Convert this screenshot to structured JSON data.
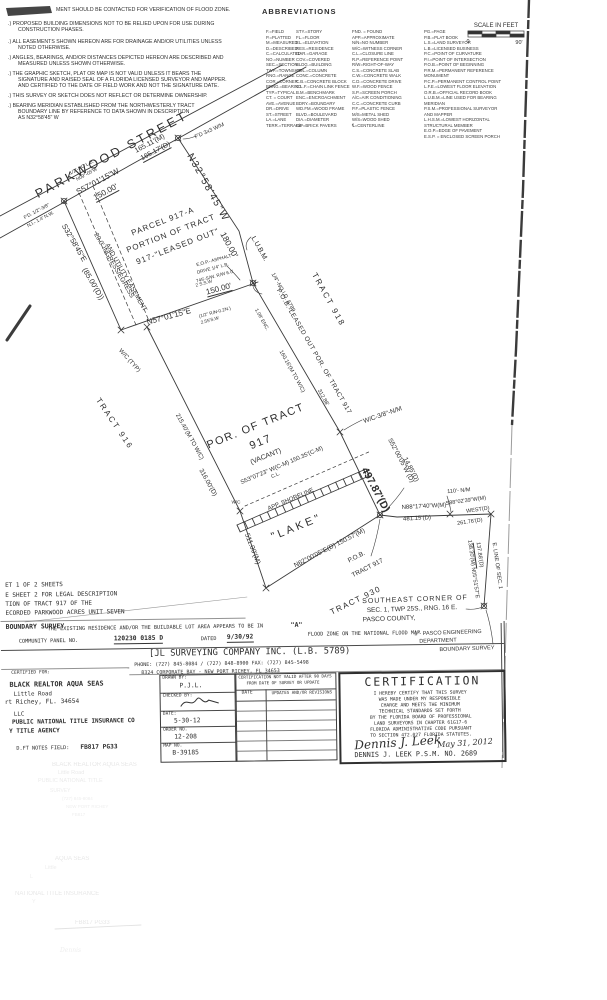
{
  "document": {
    "kind": "Boundary Survey plat (scanned)",
    "survey_title": "BOUNDARY SURVEY",
    "sheet_block": [
      "ET 1 OF 2 SHEETS",
      "E SHEET 2 FOR LEGAL DESCRIPTION",
      "TION OF TRACT 917 OF THE",
      "ECORDED PARKWOOD ACRES UNIT SEVEN"
    ]
  },
  "scale_bar": {
    "label": "SCALE IN FEET",
    "left_tick": "0",
    "right_tick": "90'"
  },
  "abbr": {
    "title": "ABBREVIATIONS",
    "col_x": [
      266,
      296,
      352,
      424
    ],
    "col_w": [
      30,
      55,
      70,
      80
    ],
    "top_y": 29,
    "cols": [
      [
        "F.=FIELD",
        "P.=PLATTED",
        "M.=MEASURED",
        "D.=DESCRIBED",
        "C.=CALCULATED",
        "NO.=NUMBER",
        "SEC.=SECTION",
        "TWP.=TOWNSHIP",
        "RNG.=RANGE",
        "COR.=CORNER",
        "BRNG.=BEARING",
        "TYP.=TYPICAL",
        "CT. = COURT",
        "AVE.=AVENUE",
        "DR.=DRIVE",
        "ST.=STREET",
        "LA.=LANE",
        "TERR.=TERRACE"
      ],
      [
        "STY.=STORY",
        "FL.=FLOOR",
        "EL.=ELEVATION",
        "RES.=RESIDENCE",
        "GAR.=GARAGE",
        "COV.=COVERED",
        "BLDG.=BUILDING",
        "COL.=COLUMN",
        "CONC.=CONCRETE",
        "C.B.=CONCRETE BLOCK",
        "C.L.F.=CHAIN LINK FENCE",
        "B.M.=BENCHMARK",
        "ENC.=ENCROACHMENT",
        "BDRY.=BOUNDARY",
        "WD.FM.=WOOD FRAME",
        "BLVD.=BOULEVARD",
        "DIA.=DIAMETER",
        "B/P=BRICK PAVERS"
      ],
      [
        "FND. = FOUND",
        "APP.=APPROXIMATE",
        "N/N=NO NUMBER",
        "W/C=WITNESS CORNER",
        "C.L.=CLOSURE LINE",
        "R.P.=REFERENCE POINT",
        "R/W=RIGHT-OF-WAY",
        "C.S.=CONCRETE SLAB",
        "C.W.=CONCRETE WALK",
        "C.D.=CONCRETE DRIVE",
        "W.F.=WOOD FENCE",
        "S.P.=SCREEN PORCH",
        "A/C=AIR CONDITIONING",
        "C.C.=CONCRETE CURB",
        "P.F.=PLASTIC FENCE",
        "M/S=METAL SHED",
        "W/S=WOOD SHED",
        "℄=CENTERLINE"
      ],
      [
        "PG.=PAGE",
        "P.B.=PLAT BOOK",
        "L.S.=LAND SURVEYOR",
        "L.B.=LICENSED BUSINESS",
        "P.C.=POINT OF CURVATURE",
        "P.I.=POINT OF INTERSECTION",
        "P.O.B.=POINT OF BEGINNING",
        "P.R.M.=PERMANENT REFERENCE MONUMENT",
        "P.C.P.=PERMANENT CONTROL POINT",
        "L.F.E.=LOWEST FLOOR ELEVATION",
        "O.R.B.=OFFICIAL RECORD BOOK",
        "L.U.B.M.=LINE USED FOR BEARING MERIDIAN",
        "P.S.M.=PROFESSIONAL SURVEYOR AND MAPPER",
        "L.H.S.M.=LOWEST HORIZONTAL STRUCTURAL MEMBER",
        "E.O.P.=EDGE OF PAVEMENT",
        "E.S.P. = ENCLOSED SCREEN PORCH"
      ]
    ]
  },
  "notes": [
    {
      "t": "MENT SHOULD BE CONTACTED FOR VERIFICATION OF FLOOD ZONE.",
      "x": 56,
      "y": 8
    },
    {
      "t": ".) PROPOSED BUILDING DIMENSIONS NOT TO BE RELIED UPON FOR USE DURING",
      "x": 8,
      "y": 22
    },
    {
      "t": "CONSTRUCTION PHASES.",
      "x": 18,
      "y": 28
    },
    {
      "t": ".) ALL EASEMENTS SHOWN HEREON ARE FOR DRAINAGE AND/OR UTILITIES UNLESS",
      "x": 8,
      "y": 40
    },
    {
      "t": "NOTED OTHERWISE.",
      "x": 18,
      "y": 46
    },
    {
      "t": ".) ANGLES, BEARINGS, AND/OR DISTANCES DEPICTED HEREON ARE DESCRIBED AND",
      "x": 8,
      "y": 56
    },
    {
      "t": "MEASURED UNLESS SHOWN OTHERWISE.",
      "x": 18,
      "y": 62
    },
    {
      "t": ".) THE GRAPHIC SKETCH, PLAT OR MAP IS NOT VALID UNLESS IT BEARS THE",
      "x": 8,
      "y": 72
    },
    {
      "t": "SIGNATURE AND RAISED SEAL OF A FLORIDA LICENSED SURVEYOR AND MAPPER.",
      "x": 18,
      "y": 78
    },
    {
      "t": "AND CERTIFIED TO THE DATE OF FIELD WORK AND NOT THE SIGNATURE DATE.",
      "x": 18,
      "y": 84
    },
    {
      "t": ".) THIS SURVEY OR SKETCH DOES NOT REFLECT OR DETERMINE OWNERSHIP.",
      "x": 8,
      "y": 94
    },
    {
      "t": ".) BEARING MERIDIAN ESTABLISHED FROM THE NORTHWESTERLY TRACT",
      "x": 8,
      "y": 104
    },
    {
      "t": "BOUNDARY LINE BY REFERENCE TO DATA SHOWN IN DESCRIPTION",
      "x": 18,
      "y": 110
    },
    {
      "t": "AS N32°58'45\" W",
      "x": 18,
      "y": 116
    }
  ],
  "plat_labels": [
    {
      "t": "SCALE IN FEET",
      "x": 496,
      "y": 26,
      "s": 6,
      "n": "scale-bar-label"
    },
    {
      "t": "0",
      "x": 468,
      "y": 43,
      "s": 5.5,
      "n": "scale-zero"
    },
    {
      "t": "90'",
      "x": 519,
      "y": 44,
      "s": 5.5,
      "n": "scale-ninety"
    },
    {
      "t": "PARKWOOD  STREET",
      "x": 112,
      "y": 155,
      "r": -28,
      "s": 12.5,
      "ls": 3,
      "n": "parkwood-street-label"
    },
    {
      "t": "165.11'(M)",
      "x": 150,
      "y": 144,
      "r": -28,
      "s": 7
    },
    {
      "t": "165.17'(D)",
      "x": 156,
      "y": 152,
      "r": -28,
      "s": 7,
      "u": 1
    },
    {
      "t": "S57°01'15\"W",
      "x": 98,
      "y": 182,
      "r": -28,
      "s": 8
    },
    {
      "t": "150.00'",
      "x": 106,
      "y": 193,
      "r": -28,
      "s": 8,
      "u": 1
    },
    {
      "t": "F'D 3x3 W/M",
      "x": 210,
      "y": 132,
      "r": -24,
      "s": 5.5
    },
    {
      "t": "1/2\"-NO L.B.",
      "x": 82,
      "y": 168,
      "r": -28,
      "s": 4.8
    },
    {
      "t": "N09°-05'W",
      "x": 87,
      "y": 175,
      "r": -28,
      "s": 4.8
    },
    {
      "t": "F'D. 1/2\"-3/8\"",
      "x": 37,
      "y": 212,
      "r": -28,
      "s": 4.8
    },
    {
      "t": "N.I.- 1.4' N.W.",
      "x": 41,
      "y": 220,
      "r": -28,
      "s": 4.8
    },
    {
      "t": "N32°58'45\"W",
      "x": 207,
      "y": 188,
      "r": 61,
      "s": 10,
      "ls": 1.5
    },
    {
      "t": "180.00'",
      "x": 229,
      "y": 245,
      "r": 61,
      "s": 8.5
    },
    {
      "t": "L.U.B.M.",
      "x": 259,
      "y": 249,
      "r": 61,
      "s": 7
    },
    {
      "t": "1/4\"-NO I.D. 5789",
      "x": 282,
      "y": 293,
      "r": 61,
      "s": 5.5
    },
    {
      "t": "P.O.B.-LEASED OUT POR. OF TRACT 917",
      "x": 313,
      "y": 352,
      "r": 60,
      "s": 6.5,
      "ls": 0.5
    },
    {
      "t": "TRACT 918",
      "x": 328,
      "y": 300,
      "r": 61,
      "s": 8,
      "ls": 2,
      "n": "tract-918-label"
    },
    {
      "t": "1.08' ENC.",
      "x": 261,
      "y": 320,
      "r": 61,
      "s": 5
    },
    {
      "t": "160.16'(M TO W/C)",
      "x": 291,
      "y": 372,
      "r": 61,
      "s": 5.5
    },
    {
      "t": "312.88'",
      "x": 322,
      "y": 398,
      "r": 61,
      "s": 5.5
    },
    {
      "t": "W/C-3/8\"-N/M",
      "x": 383,
      "y": 416,
      "r": -19,
      "s": 6.5
    },
    {
      "t": "497.87'(D)",
      "x": 375,
      "y": 490,
      "r": 62,
      "s": 10.5,
      "w": 700
    },
    {
      "t": "S52°00'05\"W (D)",
      "x": 400,
      "y": 461,
      "r": 62,
      "s": 6.5
    },
    {
      "t": "14.85'(D)",
      "x": 410,
      "y": 470,
      "r": 62,
      "s": 6.5
    },
    {
      "t": "S32°58'45\"E",
      "x": 74,
      "y": 243,
      "r": 60,
      "s": 7.5
    },
    {
      "t": "(85.00'(D))",
      "x": 93,
      "y": 284,
      "r": 60,
      "s": 7.5
    },
    {
      "t": "20.0' INGRESS/EGRESS",
      "x": 113,
      "y": 266,
      "r": 60,
      "s": 6.5
    },
    {
      "t": "AND UTILITY EASEMENT",
      "x": 125,
      "y": 278,
      "r": 60,
      "s": 6.5
    },
    {
      "t": "W/C (TYP)",
      "x": 129,
      "y": 361,
      "r": 48,
      "s": 6
    },
    {
      "t": "PARCEL 917-A",
      "x": 163,
      "y": 222,
      "r": -21,
      "s": 8,
      "ls": 1,
      "n": "parcel-917a-label"
    },
    {
      "t": "PORTION OF TRACT",
      "x": 171,
      "y": 234,
      "r": -21,
      "s": 8,
      "ls": 1
    },
    {
      "t": "917-\"LEASED OUT\"",
      "x": 178,
      "y": 247,
      "r": -21,
      "s": 8,
      "ls": 1
    },
    {
      "t": "N57°01'15\"E",
      "x": 169,
      "y": 317,
      "r": -15,
      "s": 8
    },
    {
      "t": "150.00'",
      "x": 219,
      "y": 290,
      "r": -15,
      "s": 8,
      "u": 1
    },
    {
      "t": "E.O.P.- ASPHALT",
      "x": 214,
      "y": 261,
      "r": -15,
      "s": 4.6
    },
    {
      "t": "DRIVE  1/4\" L.B.",
      "x": 213,
      "y": 269,
      "r": -15,
      "s": 4.6
    },
    {
      "t": "745'-S/W. R/W  6.0'",
      "x": 215,
      "y": 277,
      "r": -15,
      "s": 4.6
    },
    {
      "t": "2 S.S.W",
      "x": 204,
      "y": 284,
      "r": -15,
      "s": 4.6
    },
    {
      "t": "(1/2\" R/N-0.2N.)",
      "x": 215,
      "y": 313,
      "r": -15,
      "s": 4.6
    },
    {
      "t": "2.55'S.W",
      "x": 210,
      "y": 321,
      "r": -15,
      "s": 4.6
    },
    {
      "t": "TRACT 916",
      "x": 114,
      "y": 424,
      "r": 56,
      "s": 8,
      "ls": 2,
      "n": "tract-916-label"
    },
    {
      "t": "215.40'(M TO W/C)",
      "x": 189,
      "y": 437,
      "r": 61,
      "s": 6
    },
    {
      "t": "316.00'(D)",
      "x": 207,
      "y": 483,
      "r": 61,
      "s": 6.5
    },
    {
      "t": "W/C",
      "x": 236,
      "y": 503,
      "s": 4.6
    },
    {
      "t": "511.00'(M)",
      "x": 252,
      "y": 549,
      "r": 69,
      "s": 7
    },
    {
      "t": "POR. OF TRACT",
      "x": 256,
      "y": 427,
      "r": -22,
      "s": 11,
      "ls": 1.5,
      "n": "tract-917-label"
    },
    {
      "t": "917",
      "x": 261,
      "y": 443,
      "r": -22,
      "s": 11,
      "ls": 1.5
    },
    {
      "t": "(VACANT)",
      "x": 266,
      "y": 457,
      "r": -22,
      "s": 7
    },
    {
      "t": "S53°07'23\" W(C-M) 150.35'(C-M)",
      "x": 282,
      "y": 466,
      "r": -23,
      "s": 6
    },
    {
      "t": "C.L.",
      "x": 276,
      "y": 476,
      "r": -23,
      "s": 5
    },
    {
      "t": "APP. SHORELINE",
      "x": 291,
      "y": 500,
      "r": -23,
      "s": 6
    },
    {
      "t": "\"LAKE\"",
      "x": 297,
      "y": 528,
      "r": -22,
      "s": 11,
      "ls": 3,
      "n": "lake-label"
    },
    {
      "t": "N62°00'05\"E(D) 150.57'(M)",
      "x": 330,
      "y": 549,
      "r": -27,
      "s": 6.5
    },
    {
      "t": "P.O.B.",
      "x": 357,
      "y": 558,
      "r": -27,
      "s": 6.5
    },
    {
      "t": "TRACT 917",
      "x": 368,
      "y": 569,
      "r": -27,
      "s": 6.5
    },
    {
      "t": "TRACT 930",
      "x": 356,
      "y": 601,
      "r": -26,
      "s": 8,
      "ls": 1.5,
      "n": "tract-930-label"
    },
    {
      "t": "110'- N/M",
      "x": 459,
      "y": 492,
      "r": -5,
      "s": 5.5
    },
    {
      "t": "N88°17'40\"W(M)",
      "x": 424,
      "y": 507,
      "r": -3,
      "s": 6
    },
    {
      "t": "481.15'(D)",
      "x": 417,
      "y": 519,
      "r": -3,
      "s": 6
    },
    {
      "t": "S88°02'39\"W(M)",
      "x": 466,
      "y": 502,
      "r": -8,
      "s": 5.5
    },
    {
      "t": "WEST(D)",
      "x": 478,
      "y": 511,
      "r": -8,
      "s": 5.5
    },
    {
      "t": "261.76'(D)",
      "x": 470,
      "y": 523,
      "r": -8,
      "s": 5.5
    },
    {
      "t": "138.30'(M)",
      "x": 470,
      "y": 553,
      "r": 82,
      "s": 5.5
    },
    {
      "t": "137.88'(D)",
      "x": 478,
      "y": 555,
      "r": 82,
      "s": 5.5,
      "u": 1
    },
    {
      "t": "N05°51'57\"E",
      "x": 474,
      "y": 583,
      "r": 82,
      "s": 5.5
    },
    {
      "t": "E. LINE OF SEC. 1",
      "x": 496,
      "y": 566,
      "r": 82,
      "s": 5.5
    },
    {
      "t": "SOUTHEAST CORNER OF",
      "x": 415,
      "y": 600,
      "r": -2,
      "s": 7,
      "ls": 1,
      "n": "southeast-corner-note"
    },
    {
      "t": "SEC. 1, TWP 25S., RNG. 16 E.",
      "x": 412,
      "y": 610,
      "r": -2,
      "s": 6.5
    },
    {
      "t": "PASCO COUNTY,",
      "x": 389,
      "y": 620,
      "r": -2,
      "s": 6.5
    },
    {
      "t": "1\"- PASCO ENGINEERING",
      "x": 448,
      "y": 634,
      "r": -2,
      "s": 5.5
    },
    {
      "t": "DEPARTMENT",
      "x": 438,
      "y": 642,
      "r": -2,
      "s": 5.5
    },
    {
      "t": "BOUNDARY SURVEY",
      "x": 467,
      "y": 650,
      "r": -2,
      "s": 5.5
    }
  ],
  "bottom_labels": [
    {
      "t": "ET 1 OF 2 SHEETS",
      "x": 5,
      "y": 1,
      "s": 6,
      "m": 1
    },
    {
      "t": "E SHEET 2 FOR LEGAL DESCRIPTION",
      "x": 5,
      "y": 11,
      "s": 6,
      "m": 1
    },
    {
      "t": "TION OF TRACT 917 OF THE",
      "x": 5,
      "y": 20,
      "s": 6,
      "m": 1
    },
    {
      "t": "ECORDED PARKWOOD ACRES UNIT SEVEN",
      "x": 5,
      "y": 29,
      "s": 6,
      "m": 1
    },
    {
      "t": "BOUNDARY SURVEY",
      "x": 5,
      "y": 42,
      "s": 6.5,
      "m": 1,
      "w": 700,
      "n": "survey-type-title"
    },
    {
      "t": "THE EXISTING RESIDENCE AND/OR THE BUILDABLE LOT AREA APPEARS TO BE IN",
      "x": 47,
      "y": 46,
      "s": 5.2,
      "m": 1
    },
    {
      "t": "\"A\"",
      "x": 290,
      "y": 44,
      "s": 6.5,
      "m": 1,
      "w": 700
    },
    {
      "t": "FLOOD ZONE ON THE NATIONAL FLOOD MAP",
      "x": 307,
      "y": 55,
      "s": 5.2,
      "m": 1
    },
    {
      "t": "COMMUNITY PANEL NO.",
      "x": 18,
      "y": 58,
      "s": 5.2,
      "m": 1
    },
    {
      "t": "120230 0185 D",
      "x": 113,
      "y": 56,
      "s": 6.3,
      "m": 1,
      "w": 700,
      "u": 1
    },
    {
      "t": "DATED",
      "x": 200,
      "y": 58,
      "s": 5.2,
      "m": 1
    },
    {
      "t": "9/30/92",
      "x": 226,
      "y": 56,
      "s": 6.3,
      "m": 1,
      "w": 700,
      "u": 1
    },
    {
      "t": "[JL SURVEYING COMPANY INC. (L.B. 5789)",
      "x": 148,
      "y": 70,
      "s": 8.8,
      "m": 1,
      "n": "company-name"
    },
    {
      "t": "PHONE: (727) 845-8084 / (727) 848-8900  FAX: (727) 845-5498",
      "x": 133,
      "y": 83,
      "s": 5,
      "m": 1,
      "n": "company-phone"
    },
    {
      "t": "8324 CORPORATE BAY - NEW PORT RICHEY, FL 34653",
      "x": 140,
      "y": 91,
      "s": 5,
      "m": 1,
      "n": "company-address"
    },
    {
      "t": "CERTIFIED FOR:",
      "x": 10,
      "y": 90,
      "s": 4.6,
      "m": 1
    },
    {
      "t": "BLACK REALTOR  AQUA SEAS",
      "x": 8,
      "y": 100,
      "s": 6.8,
      "m": 1,
      "w": 700,
      "n": "client-name"
    },
    {
      "t": "Little Road",
      "x": 12,
      "y": 110,
      "s": 5.8,
      "m": 1
    },
    {
      "t": "rt Richey, FL. 34654",
      "x": 3,
      "y": 118,
      "s": 6.2,
      "m": 1
    },
    {
      "t": "LLC",
      "x": 12,
      "y": 130,
      "s": 5.8,
      "m": 1
    },
    {
      "t": "PUBLIC NATIONAL TITLE INSURANCE CO",
      "x": 10,
      "y": 138,
      "s": 6,
      "m": 1,
      "w": 700
    },
    {
      "t": "Y TITLE AGENCY",
      "x": 7,
      "y": 147,
      "s": 6,
      "m": 1,
      "w": 700
    },
    {
      "t": "D.FT NOTES FIELD:",
      "x": 14,
      "y": 165,
      "s": 5.2,
      "m": 1
    },
    {
      "t": "FB817 PG33",
      "x": 78,
      "y": 164,
      "s": 6.2,
      "m": 1,
      "w": 700
    },
    {
      "t": "DRAWN BY:",
      "x": 161,
      "y": 97,
      "s": 4.5,
      "m": 1
    },
    {
      "t": "P.J.L.",
      "x": 178,
      "y": 104,
      "s": 6.3,
      "m": 1
    },
    {
      "t": "CHECKED BY:",
      "x": 161,
      "y": 115,
      "s": 4.5,
      "m": 1
    },
    {
      "t": "DATE:",
      "x": 161,
      "y": 133,
      "s": 4.5,
      "m": 1
    },
    {
      "t": "5-30-12",
      "x": 172,
      "y": 139,
      "s": 6.3,
      "m": 1
    },
    {
      "t": "ORDER NO.",
      "x": 161,
      "y": 149,
      "s": 4.5,
      "m": 1
    },
    {
      "t": "12-208",
      "x": 172,
      "y": 155,
      "s": 6.3,
      "m": 1
    },
    {
      "t": "MAP NO.",
      "x": 161,
      "y": 165,
      "s": 4.5,
      "m": 1
    },
    {
      "t": "B-39185",
      "x": 170,
      "y": 171,
      "s": 6.3,
      "m": 1
    },
    {
      "t": "CERTIFICATION NOT VALID AFTER 90 DAYS",
      "x": 237,
      "y": 97,
      "s": 4.2,
      "m": 1
    },
    {
      "t": "FROM DATE OF SURVEY OR UPDATE",
      "x": 245,
      "y": 103,
      "s": 4.2,
      "m": 1
    },
    {
      "t": "DATE",
      "x": 240,
      "y": 113,
      "s": 4.6,
      "m": 1
    },
    {
      "t": "UPDATES AND/OR REVISIONS",
      "x": 270,
      "y": 113,
      "s": 4.2,
      "m": 1
    },
    {
      "t": "CERTIFICATION",
      "x": 363,
      "y": 99,
      "s": 11.5,
      "m": 1,
      "ls": 2,
      "n": "certification-title"
    },
    {
      "t": "I HEREBY CERTIFY THAT THIS SURVEY",
      "x": 372,
      "y": 116,
      "s": 4.7,
      "m": 1
    },
    {
      "t": "WAS MADE UNDER MY RESPONSIBLE",
      "x": 377,
      "y": 122,
      "s": 4.7,
      "m": 1
    },
    {
      "t": "CHARGE AND MEETS THE MINIMUM",
      "x": 379,
      "y": 128,
      "s": 4.7,
      "m": 1
    },
    {
      "t": "TECHNICAL STANDARDS SET FORTH",
      "x": 377,
      "y": 134,
      "s": 4.7,
      "m": 1
    },
    {
      "t": "BY THE FLORIDA BOARD OF PROFESSIONAL",
      "x": 368,
      "y": 140,
      "s": 4.7,
      "m": 1
    },
    {
      "t": "LAND SURVEYORS IN CHAPTER 61G17-6",
      "x": 372,
      "y": 146,
      "s": 4.7,
      "m": 1
    },
    {
      "t": "FLORIDA ADMINISTRATIVE CODE PURSUANT",
      "x": 368,
      "y": 152,
      "s": 4.7,
      "m": 1
    },
    {
      "t": "TO SECTION 472.027 FLORIDA STATUTES.",
      "x": 368,
      "y": 158,
      "s": 4.7,
      "m": 1
    },
    {
      "t": "Dennis J. Leek",
      "x": 352,
      "y": 160,
      "s": 12,
      "f": "script",
      "r": -3,
      "n": "surveyor-signature"
    },
    {
      "t": "May 31, 2012",
      "x": 435,
      "y": 164,
      "s": 8,
      "f": "script",
      "r": -3,
      "n": "signature-date"
    },
    {
      "t": "DENNIS J. LEEK  P.S.M. NO. 2689",
      "x": 352,
      "y": 175,
      "s": 6.8,
      "m": 1,
      "n": "surveyor-printed-name"
    }
  ],
  "ghost_labels": [
    {
      "t": "BLACK REALTOR AQUA SEAS",
      "x": 52,
      "y": 762,
      "s": 6,
      "o": 0.15
    },
    {
      "t": "Little Road",
      "x": 58,
      "y": 771,
      "s": 5.5,
      "o": 0.13
    },
    {
      "t": "PUBLIC NATIONAL TITLE",
      "x": 38,
      "y": 779,
      "s": 5.5,
      "o": 0.12
    },
    {
      "t": "SURVEY",
      "x": 50,
      "y": 789,
      "s": 5,
      "o": 0.11
    },
    {
      "t": "(727) 845-8084",
      "x": 62,
      "y": 797,
      "s": 4.5,
      "o": 0.1
    },
    {
      "t": "NEW PORT RICHEY",
      "x": 66,
      "y": 805,
      "s": 4.5,
      "o": 0.1
    },
    {
      "t": "FB817",
      "x": 72,
      "y": 813,
      "s": 4.5,
      "o": 0.1
    },
    {
      "t": "AQUA SEAS",
      "x": 55,
      "y": 856,
      "s": 6,
      "o": 0.14
    },
    {
      "t": "Little",
      "x": 45,
      "y": 866,
      "s": 5.5,
      "o": 0.11
    },
    {
      "t": "L",
      "x": 30,
      "y": 875,
      "s": 5.5,
      "o": 0.1
    },
    {
      "t": "NATIONAL TITLE INSURANCE",
      "x": 15,
      "y": 891,
      "s": 6,
      "o": 0.14
    },
    {
      "t": "Y",
      "x": 32,
      "y": 900,
      "s": 5.5,
      "o": 0.1
    },
    {
      "t": "FB817 PG33",
      "x": 75,
      "y": 920,
      "s": 6,
      "o": 0.15
    },
    {
      "t": "Dennis",
      "x": 60,
      "y": 948,
      "s": 6,
      "o": 0.1,
      "f": "script"
    }
  ],
  "revisions_table": {
    "empty_rows": 6
  }
}
